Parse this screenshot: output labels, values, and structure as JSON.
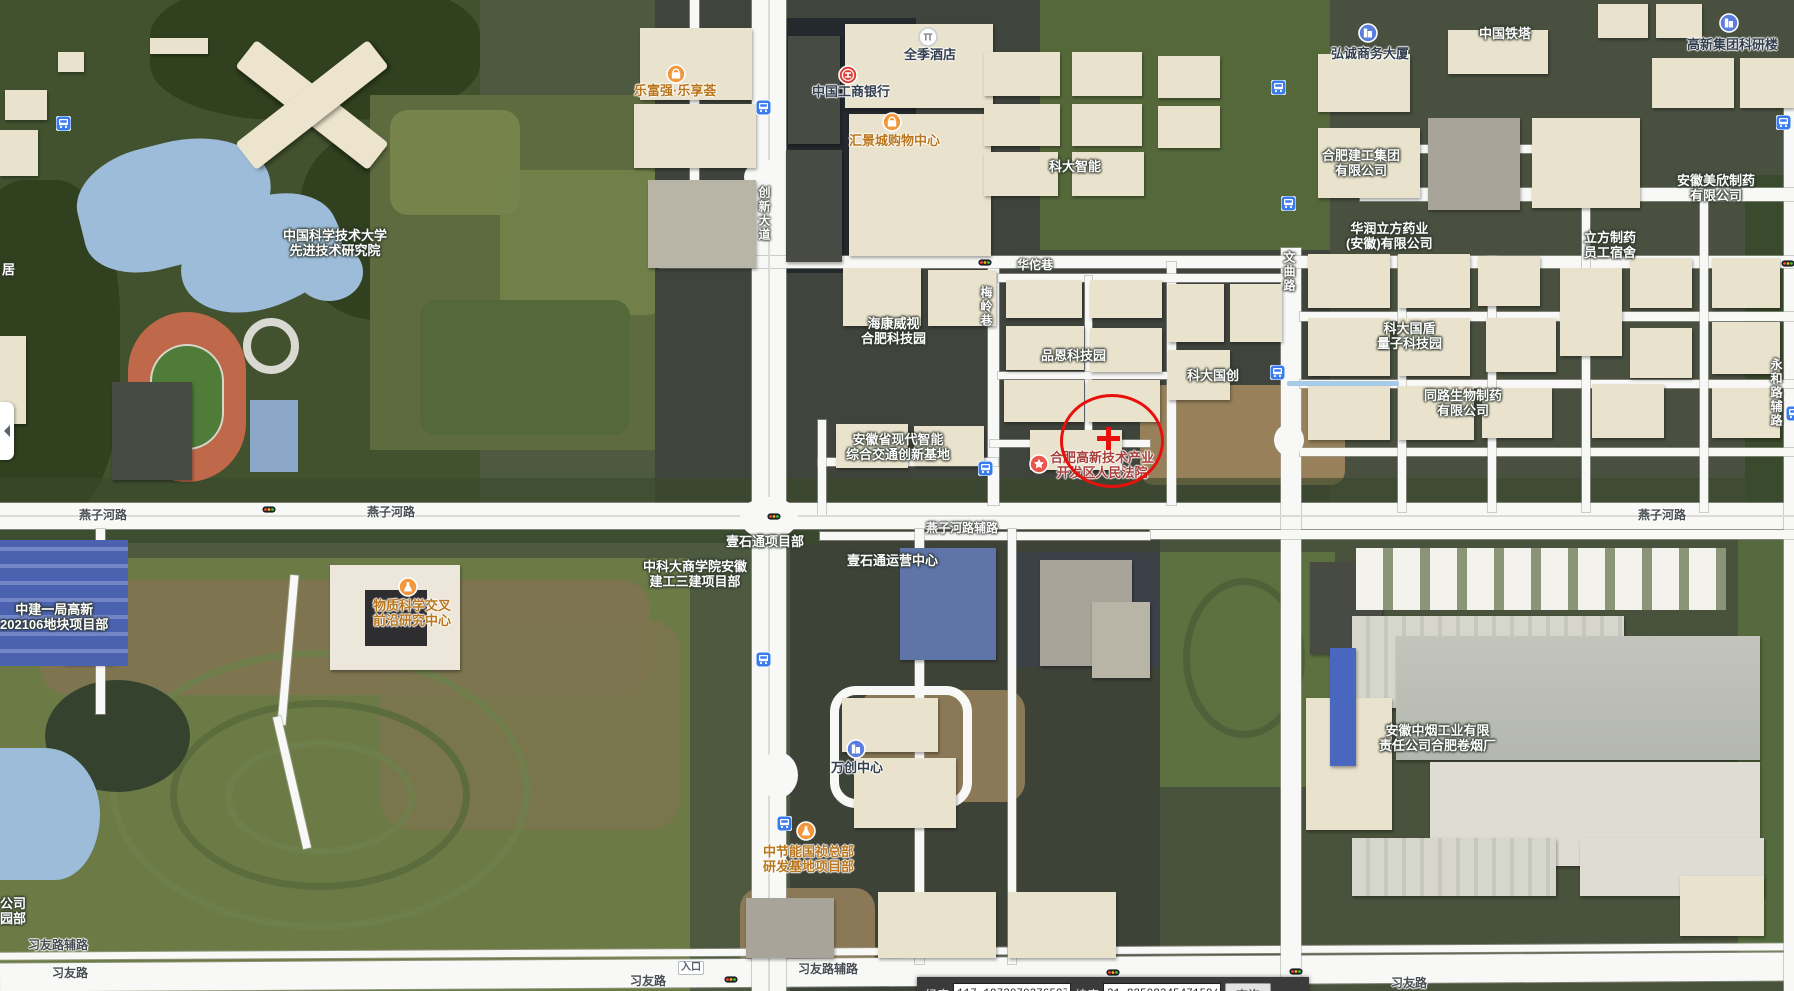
{
  "colors": {
    "selection_red": "#e8100c",
    "bus_blue": "#3a7bee",
    "poi_orange": "#f2973c",
    "water": "#9cbcd9",
    "road_white": "#f8f8f6"
  },
  "map": {
    "labels": [
      {
        "name": "label-ustc-institute",
        "style": "area-white",
        "x": 283,
        "y": 228,
        "lines": [
          "中国科学技术大学",
          "先进技术研究院"
        ],
        "interactable": true
      },
      {
        "name": "label-lefuqiang",
        "style": "poi-orange",
        "x": 634,
        "y": 83,
        "lines": [
          "乐富强·乐享荟"
        ],
        "interactable": true
      },
      {
        "name": "label-icbc",
        "style": "poi-dark",
        "x": 812,
        "y": 84,
        "lines": [
          "中国工商银行"
        ],
        "interactable": true
      },
      {
        "name": "label-quanji-hotel",
        "style": "poi-dark",
        "x": 904,
        "y": 47,
        "lines": [
          "全季酒店"
        ],
        "interactable": true
      },
      {
        "name": "label-huijing-mall",
        "style": "poi-orange",
        "x": 849,
        "y": 133,
        "lines": [
          "汇景城购物中心"
        ],
        "interactable": true
      },
      {
        "name": "label-hongcheng-tower",
        "style": "poi-dark",
        "x": 1331,
        "y": 46,
        "lines": [
          "弘诚商务大厦"
        ],
        "interactable": true
      },
      {
        "name": "label-gaoxin-research",
        "style": "poi-dark",
        "x": 1687,
        "y": 37,
        "lines": [
          "高新集团科研楼"
        ],
        "interactable": true
      },
      {
        "name": "label-china-tower",
        "style": "area-white",
        "x": 1479,
        "y": 26,
        "lines": [
          "中国铁塔"
        ],
        "interactable": true
      },
      {
        "name": "label-keda-zhineng",
        "style": "area-white",
        "x": 1049,
        "y": 159,
        "lines": [
          "科大智能"
        ],
        "interactable": true
      },
      {
        "name": "label-hefei-jiangong",
        "style": "area-white",
        "x": 1322,
        "y": 148,
        "lines": [
          "合肥建工集团",
          "有限公司"
        ],
        "interactable": true
      },
      {
        "name": "label-huarun-lifang",
        "style": "area-white",
        "x": 1346,
        "y": 221,
        "lines": [
          "华润立方药业",
          "(安徽)有限公司"
        ],
        "interactable": true
      },
      {
        "name": "label-meixin-pharma",
        "style": "area-white",
        "x": 1677,
        "y": 173,
        "lines": [
          "安徽美欣制药",
          "有限公司"
        ],
        "interactable": true
      },
      {
        "name": "label-lifang-dorm",
        "style": "area-white",
        "x": 1584,
        "y": 230,
        "lines": [
          "立方制药",
          "员工宿舍"
        ],
        "interactable": true
      },
      {
        "name": "label-hikvision",
        "style": "area-white",
        "x": 861,
        "y": 316,
        "lines": [
          "海康威视",
          "合肥科技园"
        ],
        "interactable": true
      },
      {
        "name": "label-pinen-park",
        "style": "area-white",
        "x": 1041,
        "y": 348,
        "lines": [
          "品恩科技园"
        ],
        "interactable": true
      },
      {
        "name": "label-keda-guochuang",
        "style": "area-white",
        "x": 1187,
        "y": 368,
        "lines": [
          "科大国创"
        ],
        "interactable": true
      },
      {
        "name": "label-keda-guodun",
        "style": "area-white",
        "x": 1377,
        "y": 321,
        "lines": [
          "科大国盾",
          "量子科技园"
        ],
        "interactable": true
      },
      {
        "name": "label-tonglu-bio",
        "style": "area-white",
        "x": 1424,
        "y": 388,
        "lines": [
          "同路生物制药",
          "有限公司"
        ],
        "interactable": true
      },
      {
        "name": "label-jiaotong-base",
        "style": "area-white",
        "x": 846,
        "y": 432,
        "lines": [
          "安徽省现代智能",
          "综合交通创新基地"
        ],
        "interactable": true
      },
      {
        "name": "label-court",
        "style": "poi-red",
        "x": 1050,
        "y": 450,
        "lines": [
          "合肥高新技术产业",
          "开发区人民法院"
        ],
        "interactable": true
      },
      {
        "name": "label-wuzhi-center",
        "style": "poi-orange",
        "x": 373,
        "y": 598,
        "lines": [
          "物质科学交叉",
          "前沿研究中心"
        ],
        "interactable": true
      },
      {
        "name": "label-zhongjian",
        "style": "area-white",
        "x": 0,
        "y": 602,
        "lines": [
          "中建一局高新",
          "202106地块项目部"
        ],
        "interactable": true
      },
      {
        "name": "label-zhongkeda-biz",
        "style": "area-white",
        "x": 643,
        "y": 559,
        "lines": [
          "中科大商学院安徽",
          "建工三建项目部"
        ],
        "interactable": true
      },
      {
        "name": "label-yishitong-proj",
        "style": "area-white",
        "x": 726,
        "y": 534,
        "lines": [
          "壹石通项目部"
        ],
        "interactable": true
      },
      {
        "name": "label-yishitong-ops",
        "style": "area-white",
        "x": 847,
        "y": 553,
        "lines": [
          "壹石通运营中心"
        ],
        "interactable": true
      },
      {
        "name": "label-wanchuang",
        "style": "poi-dark",
        "x": 831,
        "y": 760,
        "lines": [
          "万创中心"
        ],
        "interactable": true
      },
      {
        "name": "label-zhongjieneng",
        "style": "poi-orange",
        "x": 763,
        "y": 844,
        "lines": [
          "中节能国祯总部",
          "研发基地项目部"
        ],
        "interactable": true
      },
      {
        "name": "label-tobacco-factory",
        "style": "area-white",
        "x": 1379,
        "y": 723,
        "lines": [
          "安徽中烟工业有限",
          "责任公司合肥卷烟厂"
        ],
        "interactable": true
      },
      {
        "name": "label-partial-ju",
        "style": "area-white",
        "x": 2,
        "y": 262,
        "lines": [
          "居"
        ],
        "interactable": false
      },
      {
        "name": "label-partial-gongsi",
        "style": "area-white",
        "x": 0,
        "y": 896,
        "lines": [
          "公司"
        ],
        "interactable": false
      },
      {
        "name": "label-partial-yuanbu",
        "style": "area-white",
        "x": 0,
        "y": 911,
        "lines": [
          "园部"
        ],
        "interactable": false
      },
      {
        "name": "road-yanzihe-left",
        "style": "road-dark",
        "x": 79,
        "y": 508,
        "lines": [
          "燕子河路"
        ],
        "interactable": false
      },
      {
        "name": "road-yanzihe-mid",
        "style": "road-dark",
        "x": 367,
        "y": 505,
        "lines": [
          "燕子河路"
        ],
        "interactable": false
      },
      {
        "name": "road-yanzihe-right",
        "style": "road-dark",
        "x": 1638,
        "y": 508,
        "lines": [
          "燕子河路"
        ],
        "interactable": false
      },
      {
        "name": "road-yanzihe-fulu",
        "style": "road-white",
        "x": 926,
        "y": 521,
        "lines": [
          "燕子河路辅路"
        ],
        "interactable": false
      },
      {
        "name": "road-chuangxin-dadao",
        "style": "road-white vert",
        "x": 756,
        "y": 186,
        "lines": [
          "创新大道"
        ],
        "interactable": false
      },
      {
        "name": "road-wenqu",
        "style": "road-white vert",
        "x": 1281,
        "y": 251,
        "lines": [
          "文曲路"
        ],
        "interactable": false
      },
      {
        "name": "road-huatuo-lane",
        "style": "road-white",
        "x": 1017,
        "y": 258,
        "lines": [
          "华佗巷"
        ],
        "interactable": false
      },
      {
        "name": "road-meiling-lane",
        "style": "road-white vert",
        "x": 978,
        "y": 286,
        "lines": [
          "梅岭巷"
        ],
        "interactable": false
      },
      {
        "name": "road-yonghe-fulu",
        "style": "road-white vert",
        "x": 1768,
        "y": 358,
        "lines": [
          "永和路辅路"
        ],
        "interactable": false
      },
      {
        "name": "road-xiyou-fulu-left",
        "style": "road-dark",
        "x": 28,
        "y": 938,
        "lines": [
          "习友路辅路"
        ],
        "interactable": false
      },
      {
        "name": "road-xiyou-left",
        "style": "road-dark",
        "x": 52,
        "y": 966,
        "lines": [
          "习友路"
        ],
        "interactable": false
      },
      {
        "name": "road-xiyou-mid",
        "style": "road-dark",
        "x": 630,
        "y": 974,
        "lines": [
          "习友路"
        ],
        "interactable": false
      },
      {
        "name": "road-xiyou-fulu-mid",
        "style": "road-dark",
        "x": 798,
        "y": 962,
        "lines": [
          "习友路辅路"
        ],
        "interactable": false
      },
      {
        "name": "road-xiyou-right",
        "style": "road-dark",
        "x": 1391,
        "y": 976,
        "lines": [
          "习友路"
        ],
        "interactable": false
      },
      {
        "name": "label-entrance",
        "style": "entrance",
        "x": 678,
        "y": 961,
        "lines": [
          "入口"
        ],
        "interactable": false
      }
    ],
    "markers": {
      "bus_stops": [
        [
          63,
          123
        ],
        [
          763,
          107
        ],
        [
          1278,
          87
        ],
        [
          1288,
          203
        ],
        [
          1277,
          372
        ],
        [
          985,
          468
        ],
        [
          763,
          659
        ],
        [
          784,
          823
        ],
        [
          1783,
          122
        ],
        [
          1793,
          413
        ]
      ],
      "traffic_lights": [
        [
          269,
          509
        ],
        [
          774,
          516
        ],
        [
          985,
          262
        ],
        [
          731,
          979
        ],
        [
          1113,
          972
        ],
        [
          1296,
          971
        ],
        [
          1788,
          263
        ]
      ],
      "poi_icons": [
        {
          "type": "bag",
          "x": 676,
          "y": 74
        },
        {
          "type": "bag",
          "x": 892,
          "y": 122
        },
        {
          "type": "bank",
          "x": 848,
          "y": 75
        },
        {
          "type": "hotel",
          "x": 928,
          "y": 37
        },
        {
          "type": "building",
          "x": 1368,
          "y": 33
        },
        {
          "type": "building",
          "x": 1729,
          "y": 23
        },
        {
          "type": "building",
          "x": 856,
          "y": 749
        },
        {
          "type": "flask",
          "x": 408,
          "y": 587
        },
        {
          "type": "flask",
          "x": 806,
          "y": 831
        },
        {
          "type": "star",
          "x": 1039,
          "y": 464
        }
      ]
    },
    "selection": {
      "circle_cx": 1112,
      "circle_cy": 441,
      "cross_cx": 1108,
      "cross_cy": 438
    }
  },
  "coordbar": {
    "lng_label": "经度",
    "lng_value": "117.1973070376597",
    "lat_label": "纬度",
    "lat_value": "31.82508345471594",
    "query_label": "查询"
  },
  "panel": {
    "collapse_tooltip": "收起"
  }
}
